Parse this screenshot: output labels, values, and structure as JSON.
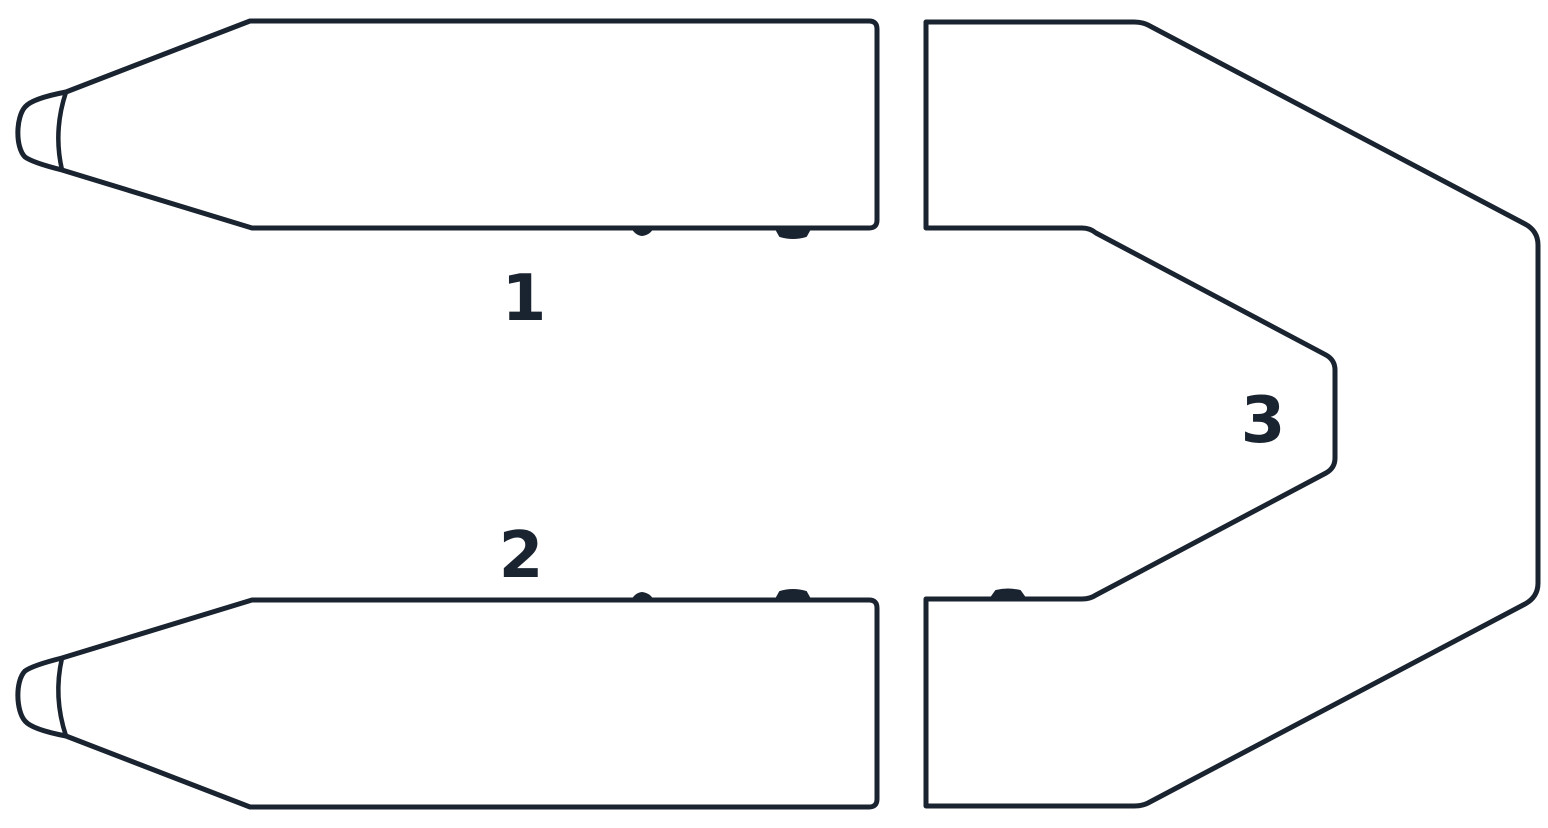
{
  "diagram": {
    "description_labels": [
      "1",
      "2",
      "3"
    ],
    "parts": [
      {
        "label": "1"
      },
      {
        "label": "2"
      },
      {
        "label": "3"
      }
    ],
    "colors": {
      "line": "#1a2330",
      "background": "#ffffff"
    }
  }
}
